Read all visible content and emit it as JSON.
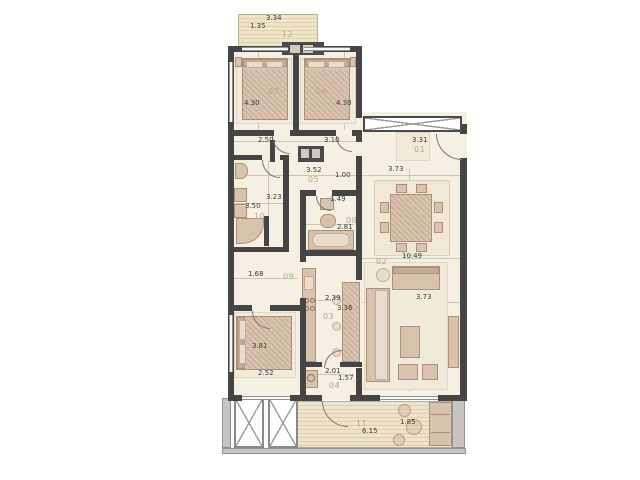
{
  "document": {
    "type": "apartment-floor-plan"
  },
  "colors": {
    "wall": "#454545",
    "floor": "#f6f0e2",
    "furniture": "#d9c2ae",
    "deck": "#eee3c8",
    "slab": "#c6c5c2",
    "dim_text": "#3c3b35",
    "room_number_text": "#b4a58f"
  },
  "rooms": {
    "r01": {
      "num": "01",
      "w": "3.31"
    },
    "r02": {
      "num": "02",
      "len": "10.49",
      "w": "3.73",
      "top_w": "3.73"
    },
    "r03": {
      "num": "03",
      "w": "2.39",
      "len": "3.36"
    },
    "r04": {
      "num": "04",
      "w": "2.01",
      "len": "1.57"
    },
    "r05": {
      "num": "05",
      "w": "3.52",
      "niche": "1.00"
    },
    "r06": {
      "num": "06",
      "len": "4.30",
      "w": "3.10"
    },
    "r07": {
      "num": "07",
      "len": "4.30",
      "w": "2.50"
    },
    "r08": {
      "num": "08",
      "w": "1.49",
      "len": "2.81"
    },
    "r09": {
      "num": "09",
      "w": "1.68"
    },
    "r10": {
      "num": "10",
      "len": "3.50",
      "w": "3.23"
    },
    "r11": {
      "num": "11",
      "len": "6.15",
      "d": "1.85"
    },
    "r12": {
      "num": "12",
      "w": "3.34",
      "d": "1.35"
    },
    "bedroom3": {
      "len": "3.81",
      "w": "2.52"
    }
  }
}
